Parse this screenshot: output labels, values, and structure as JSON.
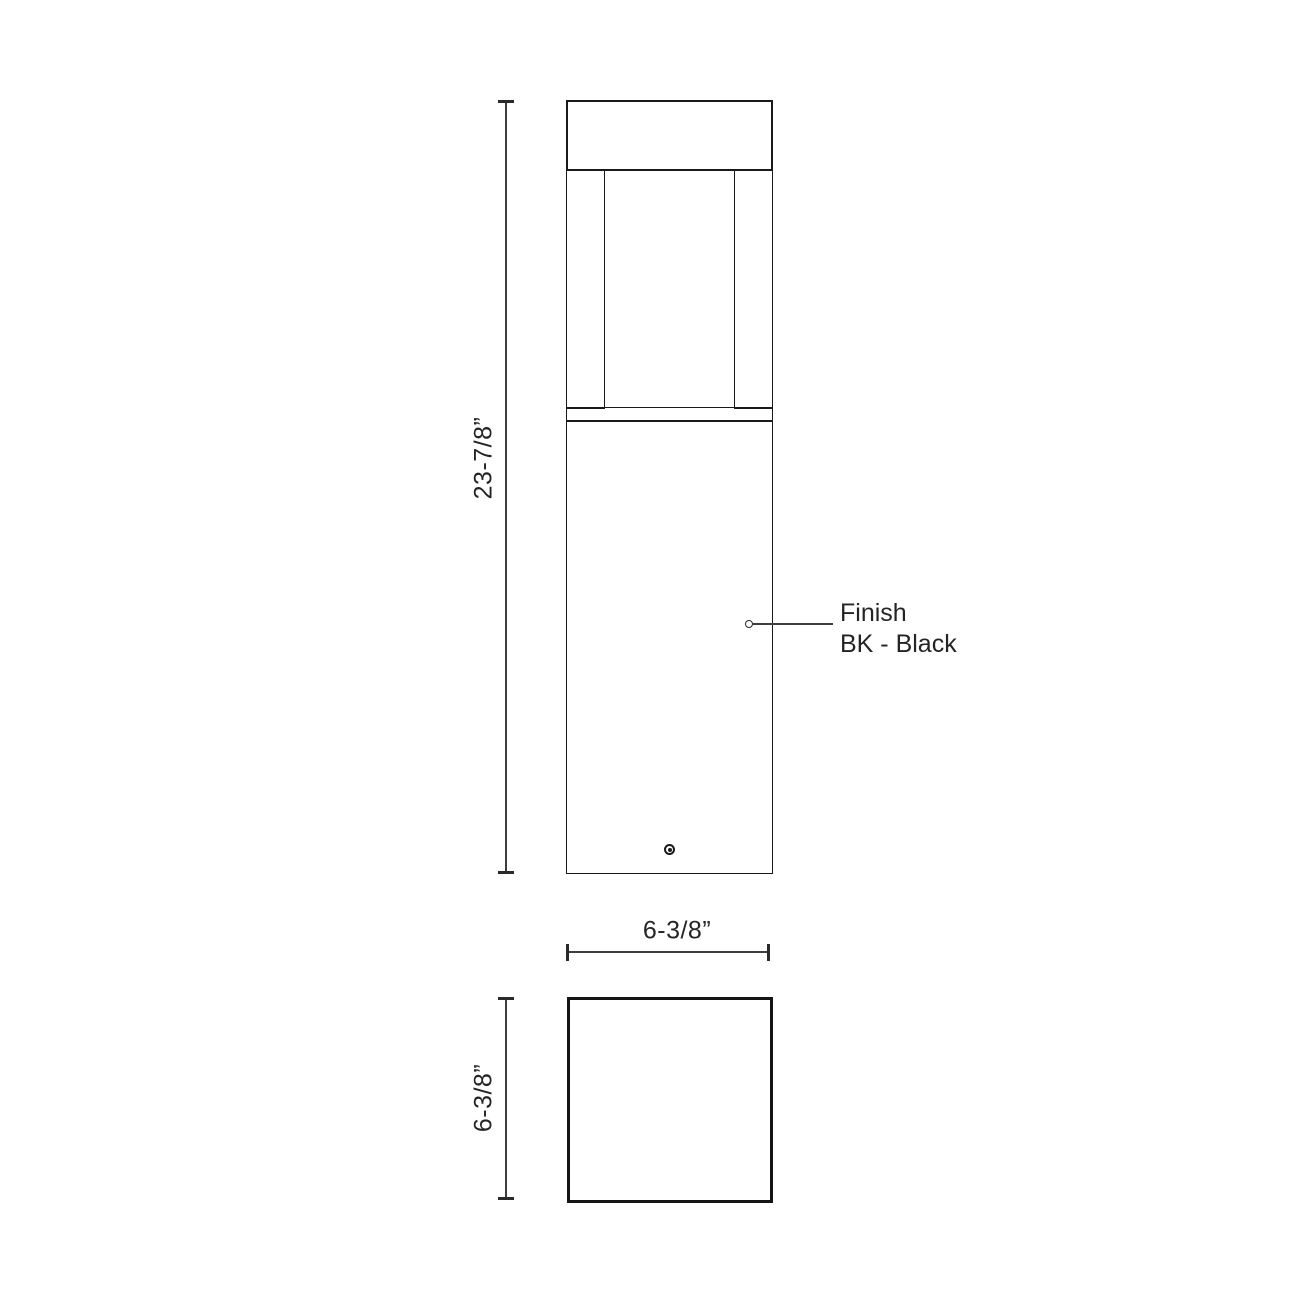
{
  "drawing": {
    "views": {
      "front_view": "bollard-front-elevation",
      "top_view": "bollard-plan-view"
    },
    "dimensions": {
      "height_label": "23-7/8”",
      "width_label": "6-3/8”",
      "depth_label": "6-3/8”"
    },
    "finish_callout": {
      "line1": "Finish",
      "line2": "BK - Black"
    },
    "colors": {
      "background": "#ffffff",
      "object_line": "#1a1a1a",
      "dimension_line": "#3d3d3d",
      "text": "#242424"
    }
  }
}
